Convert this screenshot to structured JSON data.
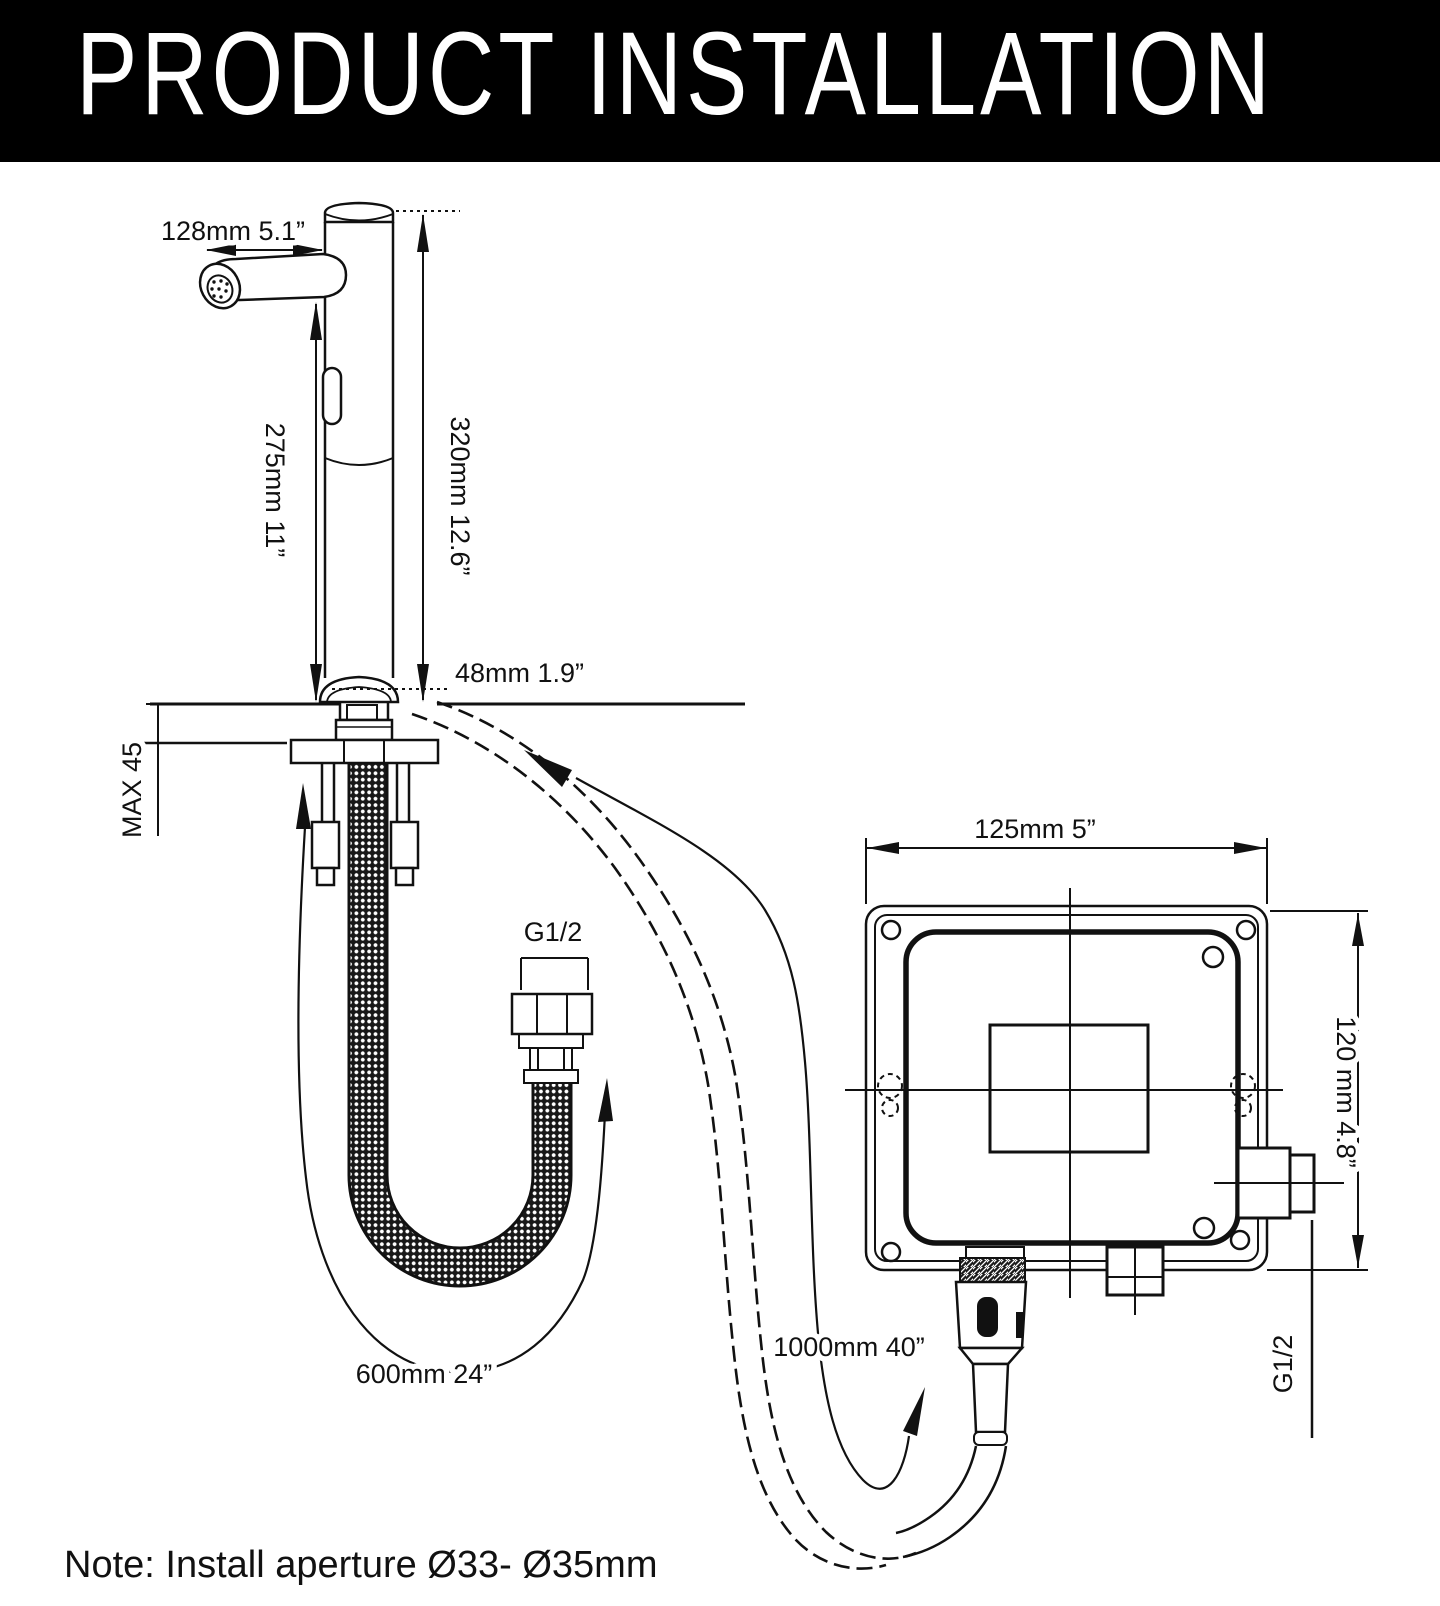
{
  "header": {
    "title": "PRODUCT INSTALLATION"
  },
  "colors": {
    "line": "#111111",
    "header_bg": "#000000",
    "header_text": "#ffffff"
  },
  "labels": {
    "spout_reach": "128mm 5.1”",
    "total_height": "320mm 12.6”",
    "spout_height": "275mm 11”",
    "base_diameter": "48mm 1.9”",
    "max_deck_thickness": "MAX 45",
    "supply_hose_thread": "G1/2",
    "supply_hose_length": "600mm 24”",
    "sensor_hose_length": "1000mm 40”",
    "box_width": "125mm 5”",
    "box_height": "120 mm 4.8”",
    "box_outlet_thread": "G1/2"
  },
  "note": {
    "text": "Note: Install aperture Ø33- Ø35mm"
  }
}
